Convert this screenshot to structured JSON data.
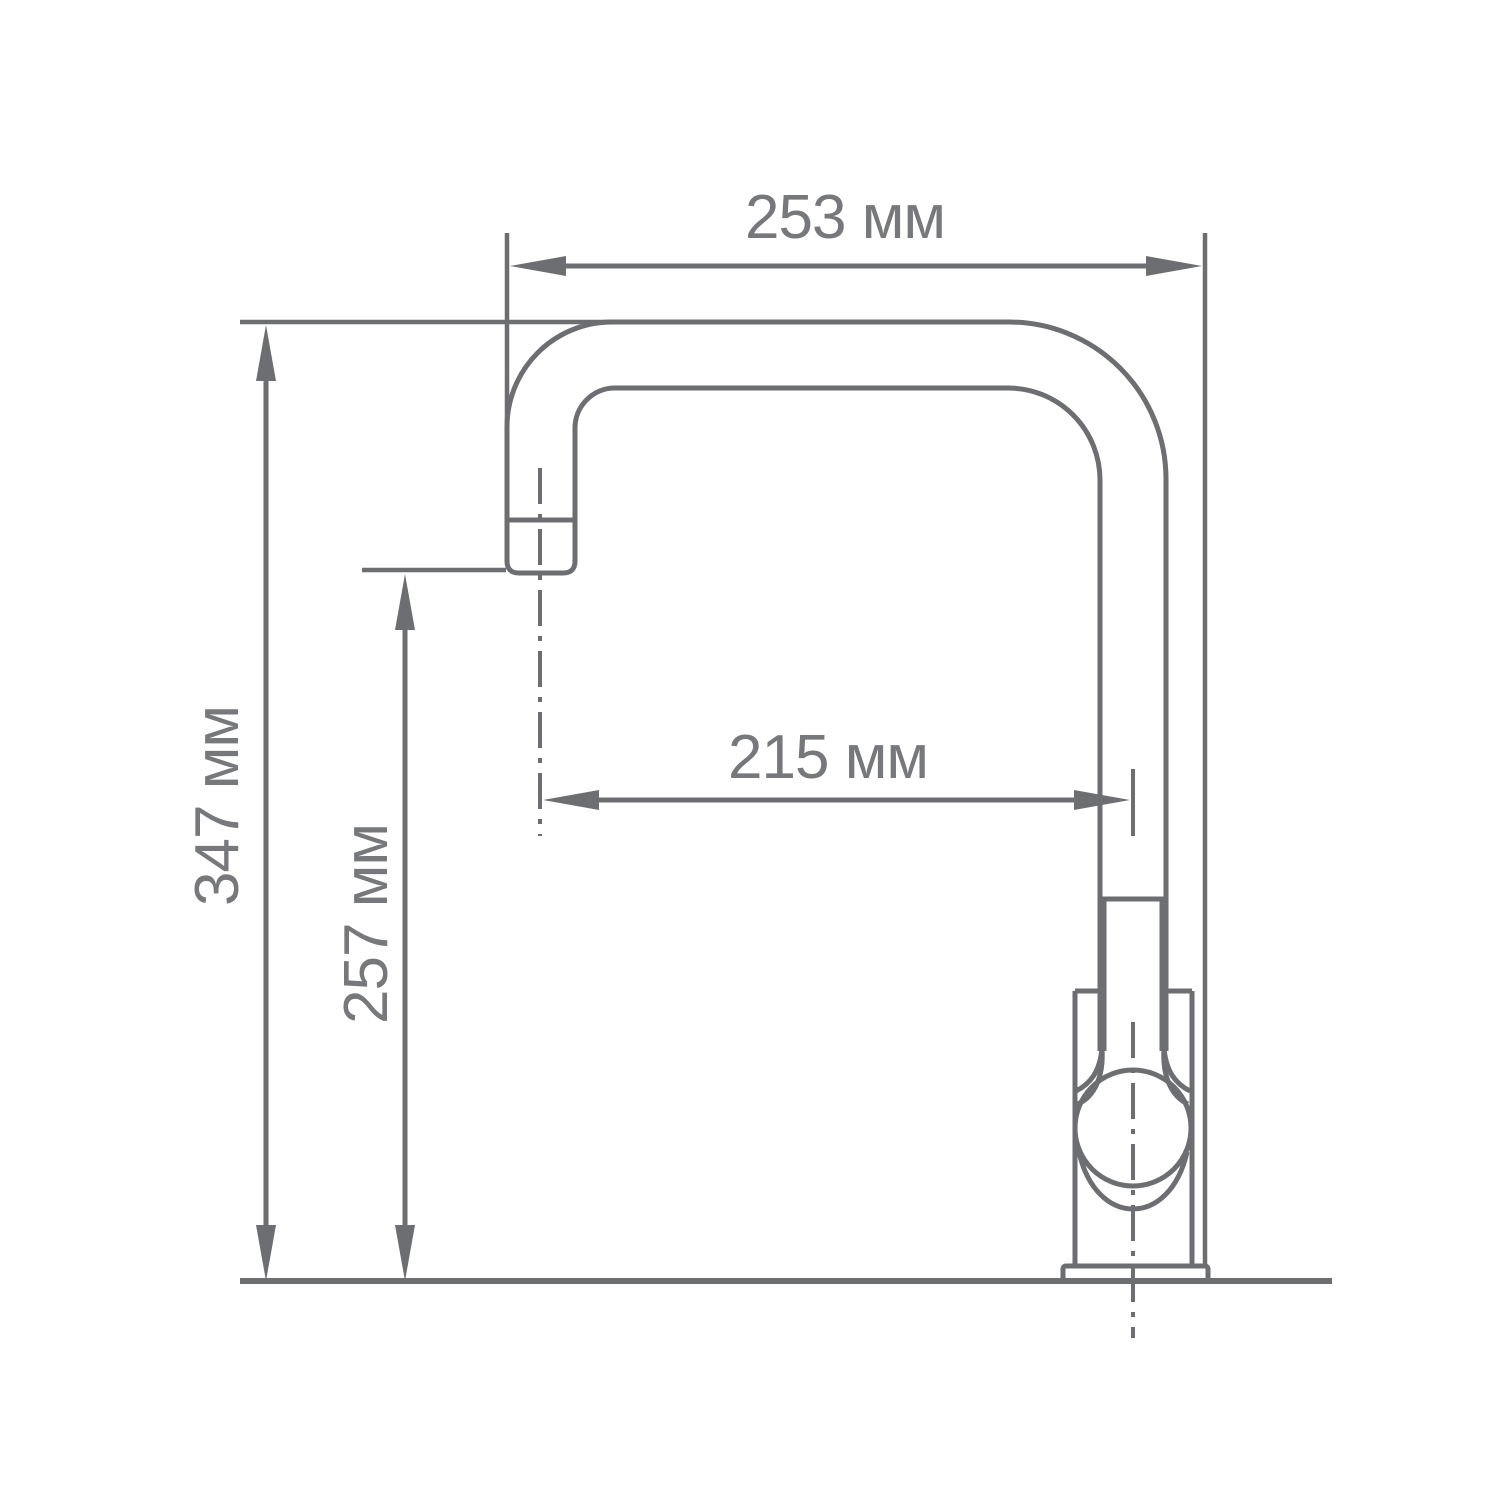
{
  "diagram": {
    "title": "faucet-dimension-drawing",
    "unit": "мм",
    "labels": {
      "overall_width": "253 мм",
      "overall_height": "347 мм",
      "spout_height": "257 мм",
      "spout_reach": "215 мм"
    },
    "values": {
      "overall_width_mm": 253,
      "overall_height_mm": 347,
      "spout_height_mm": 257,
      "spout_reach_mm": 215
    },
    "colors": {
      "line": "#6d6e71",
      "text": "#77787b",
      "background": "#ffffff"
    }
  }
}
